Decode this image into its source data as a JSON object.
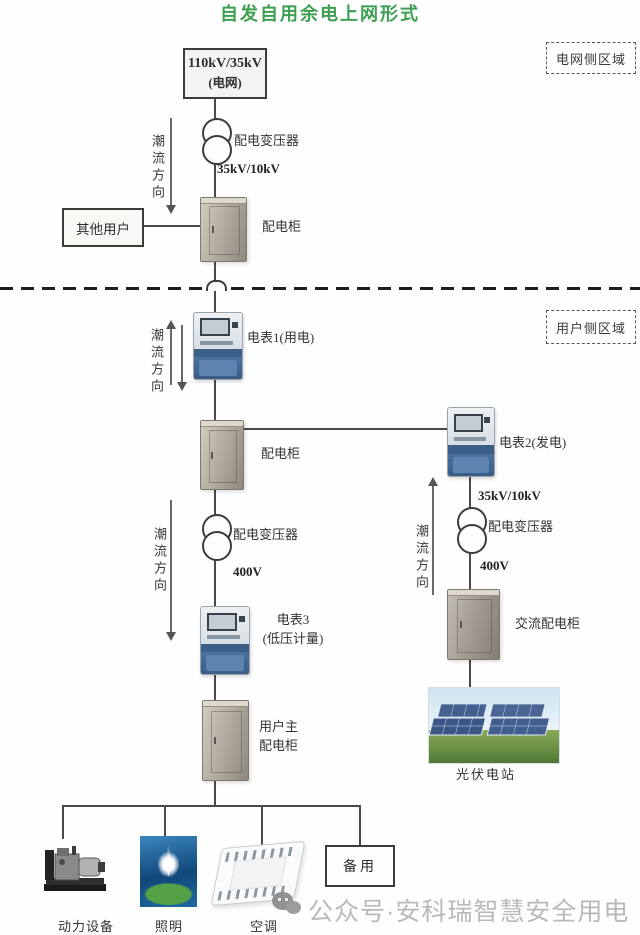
{
  "title": "自发自用余电上网形式",
  "regions": {
    "grid_side_label": "电网侧区域",
    "user_side_label": "用户侧区域"
  },
  "flow_direction_label": "潮流方向",
  "grid_side": {
    "grid_box": {
      "line1": "110kV/35kV",
      "line2": "(电网)"
    },
    "transformer": {
      "label": "配电变压器",
      "secondary_voltage": "35kV/10kV"
    },
    "other_users_label": "其他用户",
    "cabinet_label": "配电柜"
  },
  "user_side": {
    "meter1_label": "电表1(用电)",
    "cabinet_label": "配电柜",
    "transformer": {
      "label": "配电变压器",
      "secondary_voltage": "400V"
    },
    "meter3": {
      "line1": "电表3",
      "line2": "(低压计量)"
    },
    "main_cabinet": {
      "line1": "用户主",
      "line2": "配电柜"
    },
    "load_labels": [
      "动力设备",
      "照明",
      "空调"
    ],
    "spare_label": "备用"
  },
  "pv_branch": {
    "meter2_label": "电表2(发电)",
    "primary_voltage": "35kV/10kV",
    "transformer": {
      "label": "配电变压器",
      "secondary_voltage": "400V"
    },
    "ac_cabinet_label": "交流配电柜",
    "pv_station_label": "光伏电站"
  },
  "watermark": {
    "icon": "wechat-icon",
    "text": "公众号·安科瑞智慧安全用电"
  },
  "colors": {
    "title_green": "#3f9e52",
    "line": "#4a4a4a",
    "meter_blue": "#3c5f88",
    "cabinet_gray": "#b4aea2",
    "watermark_gray": "#b9b9b9"
  }
}
